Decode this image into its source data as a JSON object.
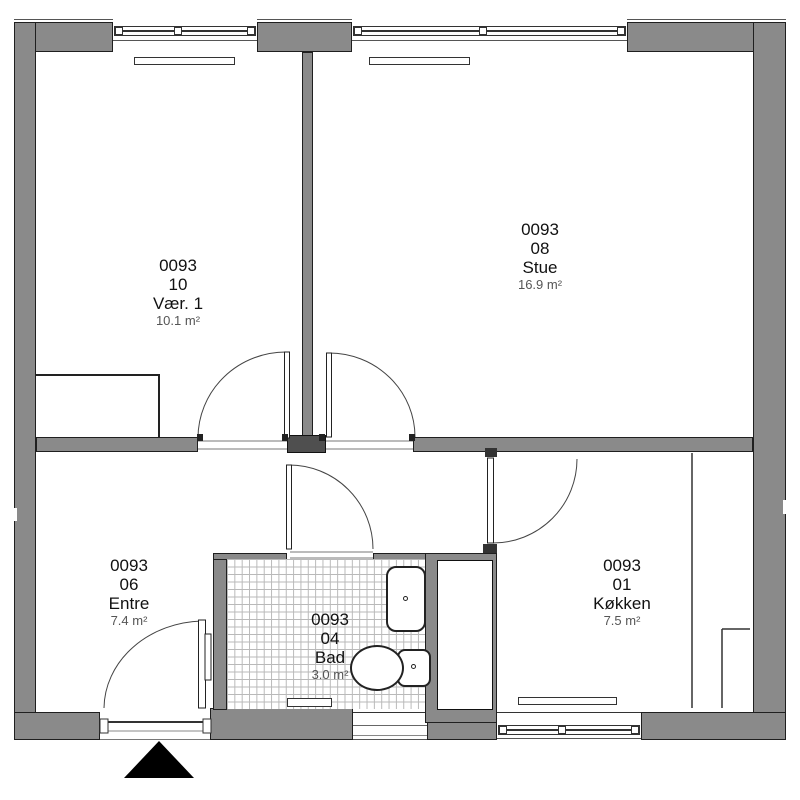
{
  "plan_title": "Apartment floor plan 0093",
  "rooms": [
    {
      "id": "0093",
      "number": "10",
      "name": "Vær. 1",
      "area": "10.1 m²"
    },
    {
      "id": "0093",
      "number": "08",
      "name": "Stue",
      "area": "16.9 m²"
    },
    {
      "id": "0093",
      "number": "06",
      "name": "Entre",
      "area": "7.4 m²"
    },
    {
      "id": "0093",
      "number": "04",
      "name": "Bad",
      "area": "3.0 m²"
    },
    {
      "id": "0093",
      "number": "01",
      "name": "Køkken",
      "area": "7.5 m²"
    }
  ],
  "colors": {
    "wall": "#8a8a8a",
    "outline": "#1f1f1f",
    "tile_line": "#b9b9b9",
    "area_text": "#555555",
    "text": "#111111",
    "entrance_marker": "#000000"
  }
}
